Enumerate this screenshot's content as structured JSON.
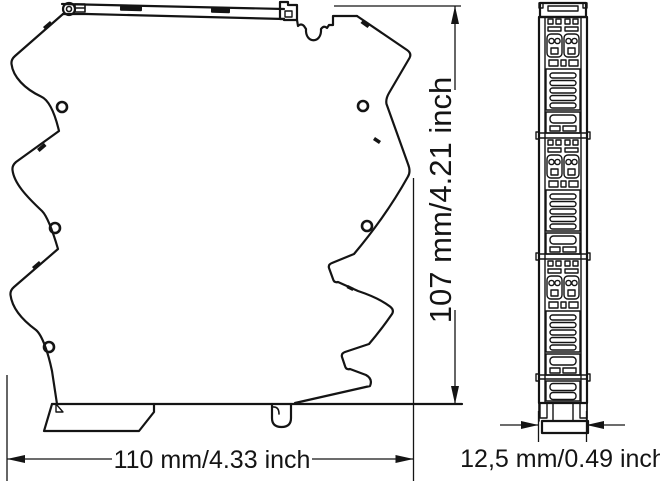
{
  "drawing": {
    "background": "#ffffff",
    "line_color": "#141414",
    "views": {
      "side": {
        "name": "module-side-profile"
      },
      "front": {
        "name": "module-front-face"
      }
    },
    "dimensions": {
      "width": {
        "label": "110 mm/4.33 inch"
      },
      "height": {
        "label": "107 mm/4.21 inch"
      },
      "depth": {
        "label": "12,5 mm/0.49 inch"
      }
    }
  }
}
